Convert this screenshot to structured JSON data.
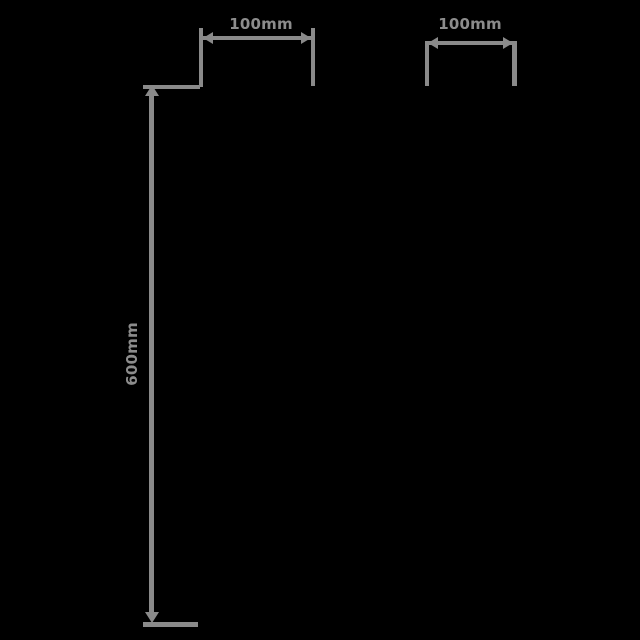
{
  "diagram": {
    "type": "dimension-drawing",
    "background_color": "#000000",
    "line_color": "#8a8a8a",
    "text_color": "#8c8c8c",
    "dimensions": {
      "width_left": {
        "label": "100mm",
        "orientation": "horizontal"
      },
      "width_right": {
        "label": "100mm",
        "orientation": "horizontal"
      },
      "height": {
        "label": "600mm",
        "orientation": "vertical"
      }
    }
  }
}
